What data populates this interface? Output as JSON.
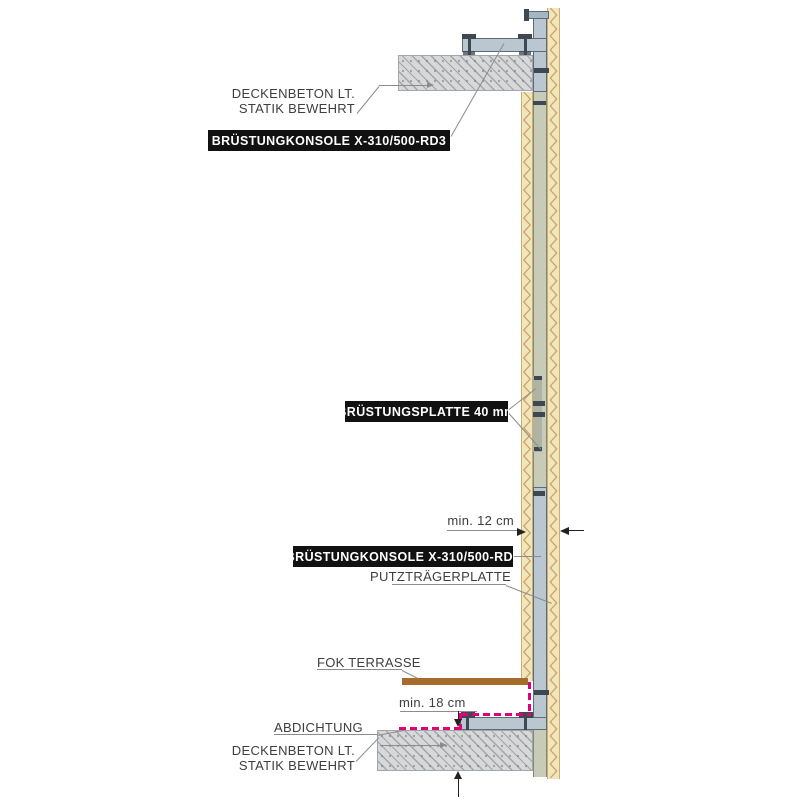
{
  "labels": {
    "deckenbeton_top_l1": "DECKENBETON LT.",
    "deckenbeton_top_l2": "STATIK BEWEHRT",
    "konsole_top": "BRÜSTUNGKONSOLE X-310/500-RD3",
    "bruestungsplatte": "BRÜSTUNGSPLATTE 40 mm",
    "dim_12": "min. 12 cm",
    "konsole_bottom": "BRÜSTUNGKONSOLE X-310/500-RD3",
    "putztraegerplatte": "PUTZTRÄGERPLATTE",
    "fok_terrasse": "FOK TERRASSE",
    "dim_18": "min. 18 cm",
    "abdichtung": "ABDICHTUNG",
    "deckenbeton_bottom_l1": "DECKENBETON LT.",
    "deckenbeton_bottom_l2": "STATIK BEWEHRT"
  },
  "colors": {
    "insulation": "#f2e5ba",
    "insulation_edge": "#c9ad72",
    "insulation_line": "#c6a066",
    "plate": "#c7cbb8",
    "plate_edge": "#838874",
    "plate_splice": "#aeb3a3",
    "steel": "#bac7d1",
    "steel_light": "#a6b6c1",
    "steel_edge": "#5a6c78",
    "steel_dark": "#3d4850",
    "concrete": "#d6d8d9",
    "sealing": "#e2007a",
    "terrace": "#a76c2c",
    "label_bg": "#111111",
    "label_fg": "#ffffff",
    "text": "#3e3e3e",
    "leader": "#8c8c8c",
    "arrow": "#222222"
  }
}
